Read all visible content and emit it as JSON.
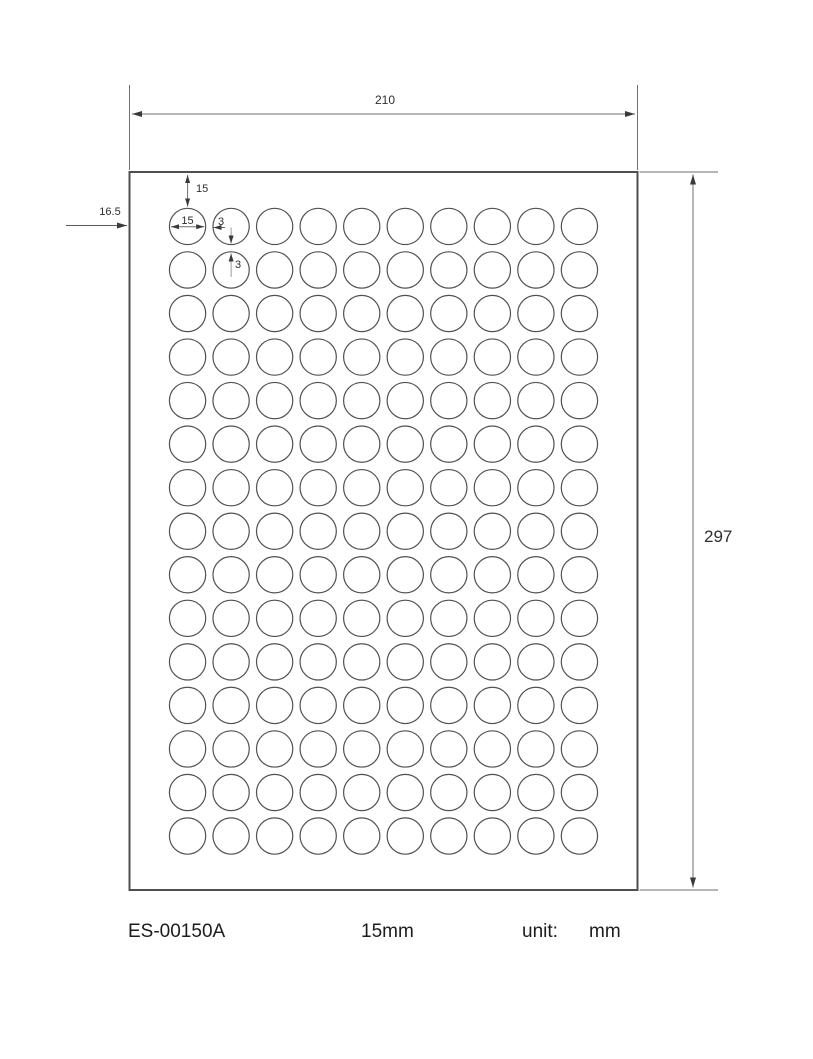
{
  "drawing": {
    "sheet_width_label": "210",
    "sheet_height_label": "297",
    "top_margin_label": "15",
    "left_margin_label": "16.5",
    "label_diameter_label": "15",
    "horizontal_gap_label": "3",
    "vertical_gap_label": "3"
  },
  "grid": {
    "columns": 10,
    "rows": 15,
    "sheet_width_mm": 210,
    "sheet_height_mm": 297,
    "label_diameter_mm": 15,
    "gap_mm": 3,
    "margin_left_mm": 16.5,
    "margin_top_mm": 15
  },
  "footer": {
    "product_code": "ES-00150A",
    "label_size": "15mm",
    "unit_label": "unit:",
    "unit_value": "mm"
  },
  "colors": {
    "outline": "#4f4f4f",
    "circle": "#515151",
    "dim_line": "#6e6e6e",
    "light_dim_line": "#9a9a9a",
    "arrow": "#3a3a3a"
  }
}
